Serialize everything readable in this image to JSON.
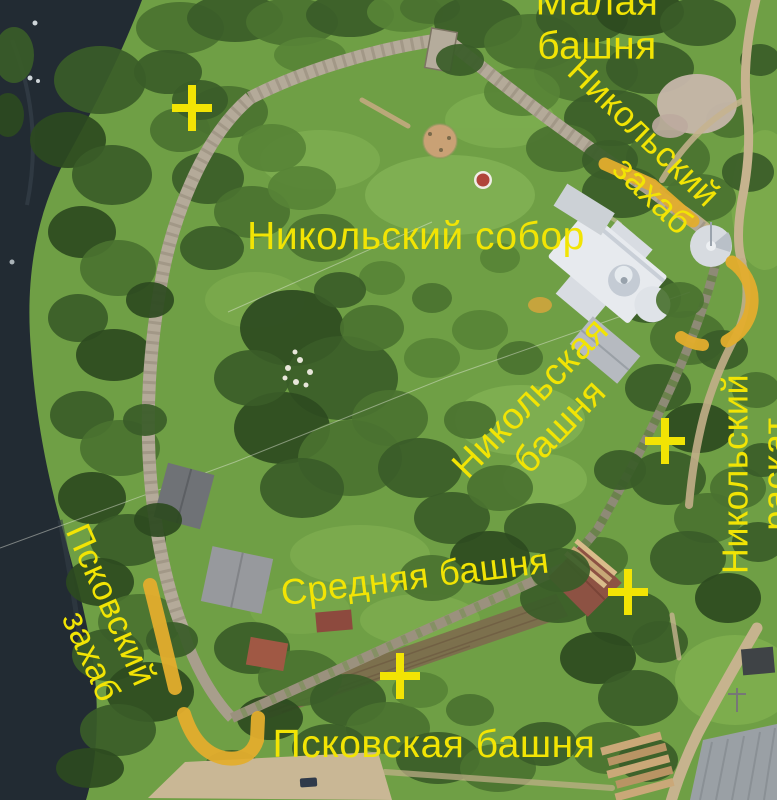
{
  "figure": {
    "description_labels_language": "ru",
    "annotation_text_color": "#f2e404",
    "route_marker_color": "#e3ad2d",
    "cross_marker_color": "#f2e404"
  },
  "labels": [
    {
      "id": "malaya-bashnya",
      "text": "Малая башня",
      "x": 597,
      "y": 24,
      "rotate": 0,
      "size": 39,
      "align": "center"
    },
    {
      "id": "nikolsky-zahab",
      "text": "Никольский\nзахаб",
      "x": 630,
      "y": 147,
      "rotate": 44,
      "size": 35,
      "align": "right"
    },
    {
      "id": "nikolsky-sobor",
      "text": "Никольский собор",
      "x": 416,
      "y": 237,
      "rotate": 0,
      "size": 39,
      "align": "center"
    },
    {
      "id": "nikolskaya-bashnya",
      "text": "Никольская башня",
      "x": 545,
      "y": 412,
      "rotate": -46,
      "size": 37,
      "align": "center"
    },
    {
      "id": "nikolsky-raskat",
      "text": "Никольский раскат",
      "x": 756,
      "y": 474,
      "rotate": -90,
      "size": 36,
      "align": "center"
    },
    {
      "id": "srednyaya-bashnya",
      "text": "Средняя башня",
      "x": 415,
      "y": 577,
      "rotate": -7,
      "size": 36,
      "align": "center"
    },
    {
      "id": "pskovsky-zahab",
      "text": "Псковский\nзахаб",
      "x": 93,
      "y": 613,
      "rotate": 66,
      "size": 35,
      "align": "right"
    },
    {
      "id": "pskovskaya-bashnya",
      "text": "Псковская башня",
      "x": 434,
      "y": 745,
      "rotate": 0,
      "size": 39,
      "align": "center"
    }
  ],
  "cross_markers": [
    {
      "id": "cross-northwest",
      "x": 192,
      "y": 108
    },
    {
      "id": "cross-east",
      "x": 665,
      "y": 441
    },
    {
      "id": "cross-southeast",
      "x": 628,
      "y": 592
    },
    {
      "id": "cross-south",
      "x": 400,
      "y": 676
    }
  ],
  "cross_geometry": {
    "arm_h": 20,
    "arm_v": 23,
    "stroke": 8
  },
  "route_markers": [
    {
      "id": "nikolsky-zahab-route",
      "d": "M 605,164 L 652,185 L 693,221",
      "width": 13
    },
    {
      "id": "nikolsky-arc",
      "d": "M 732,262 A 46,46 0 0 1 727,341",
      "width": 13
    },
    {
      "id": "nikolsky-arc-dash",
      "d": "M 703,345 Q 691,344 681,337",
      "width": 12
    },
    {
      "id": "pskovsky-zahab-route",
      "d": "M 150,585 Q 162,633 175,688",
      "width": 14
    },
    {
      "id": "pskovsky-zahab-hook",
      "d": "M 184,714 Q 196,752 224,758 Q 250,762 257,740 L 258,718",
      "width": 14
    }
  ]
}
